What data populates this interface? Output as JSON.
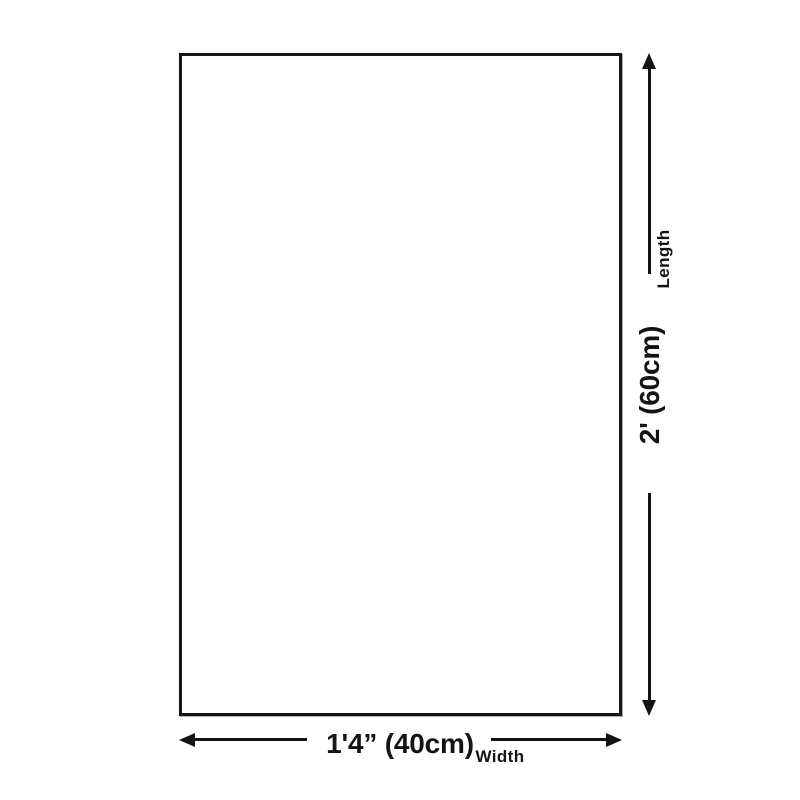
{
  "diagram": {
    "type": "product-dimension-diagram",
    "shape": "rectangle",
    "colors": {
      "background": "#ffffff",
      "line": "#141414"
    },
    "length": {
      "axis_label": "Length",
      "value": "2' (60cm)"
    },
    "width": {
      "axis_label": "Width",
      "value": "1'4” (40cm)"
    },
    "icons": {
      "arrow_up": "filled triangle up",
      "arrow_down": "filled triangle down",
      "arrow_left": "filled triangle left",
      "arrow_right": "filled triangle right"
    }
  }
}
